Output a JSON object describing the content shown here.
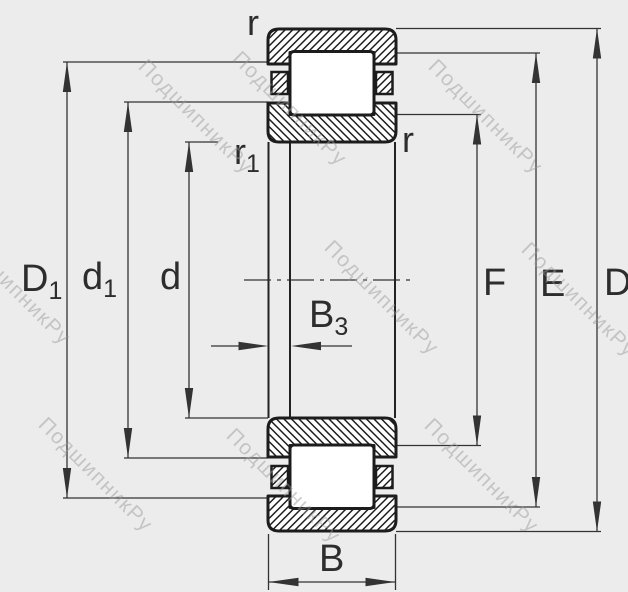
{
  "diagram_type": "bearing-cross-section-dimension-drawing",
  "watermark": {
    "text": "ПодшипникРу"
  },
  "labels": {
    "r_top": "r",
    "r_right": "r",
    "r1_main": "r",
    "r1_sub": "1",
    "D1_main": "D",
    "D1_sub": "1",
    "d1_main": "d",
    "d1_sub": "1",
    "d": "d",
    "B3_main": "B",
    "B3_sub": "3",
    "B": "B",
    "F": "F",
    "E": "E",
    "D": "D"
  },
  "colors": {
    "background": "#ececec",
    "outline": "#1c1c1c",
    "dimension_line": "#333333",
    "watermark": "#9a9a9a"
  }
}
